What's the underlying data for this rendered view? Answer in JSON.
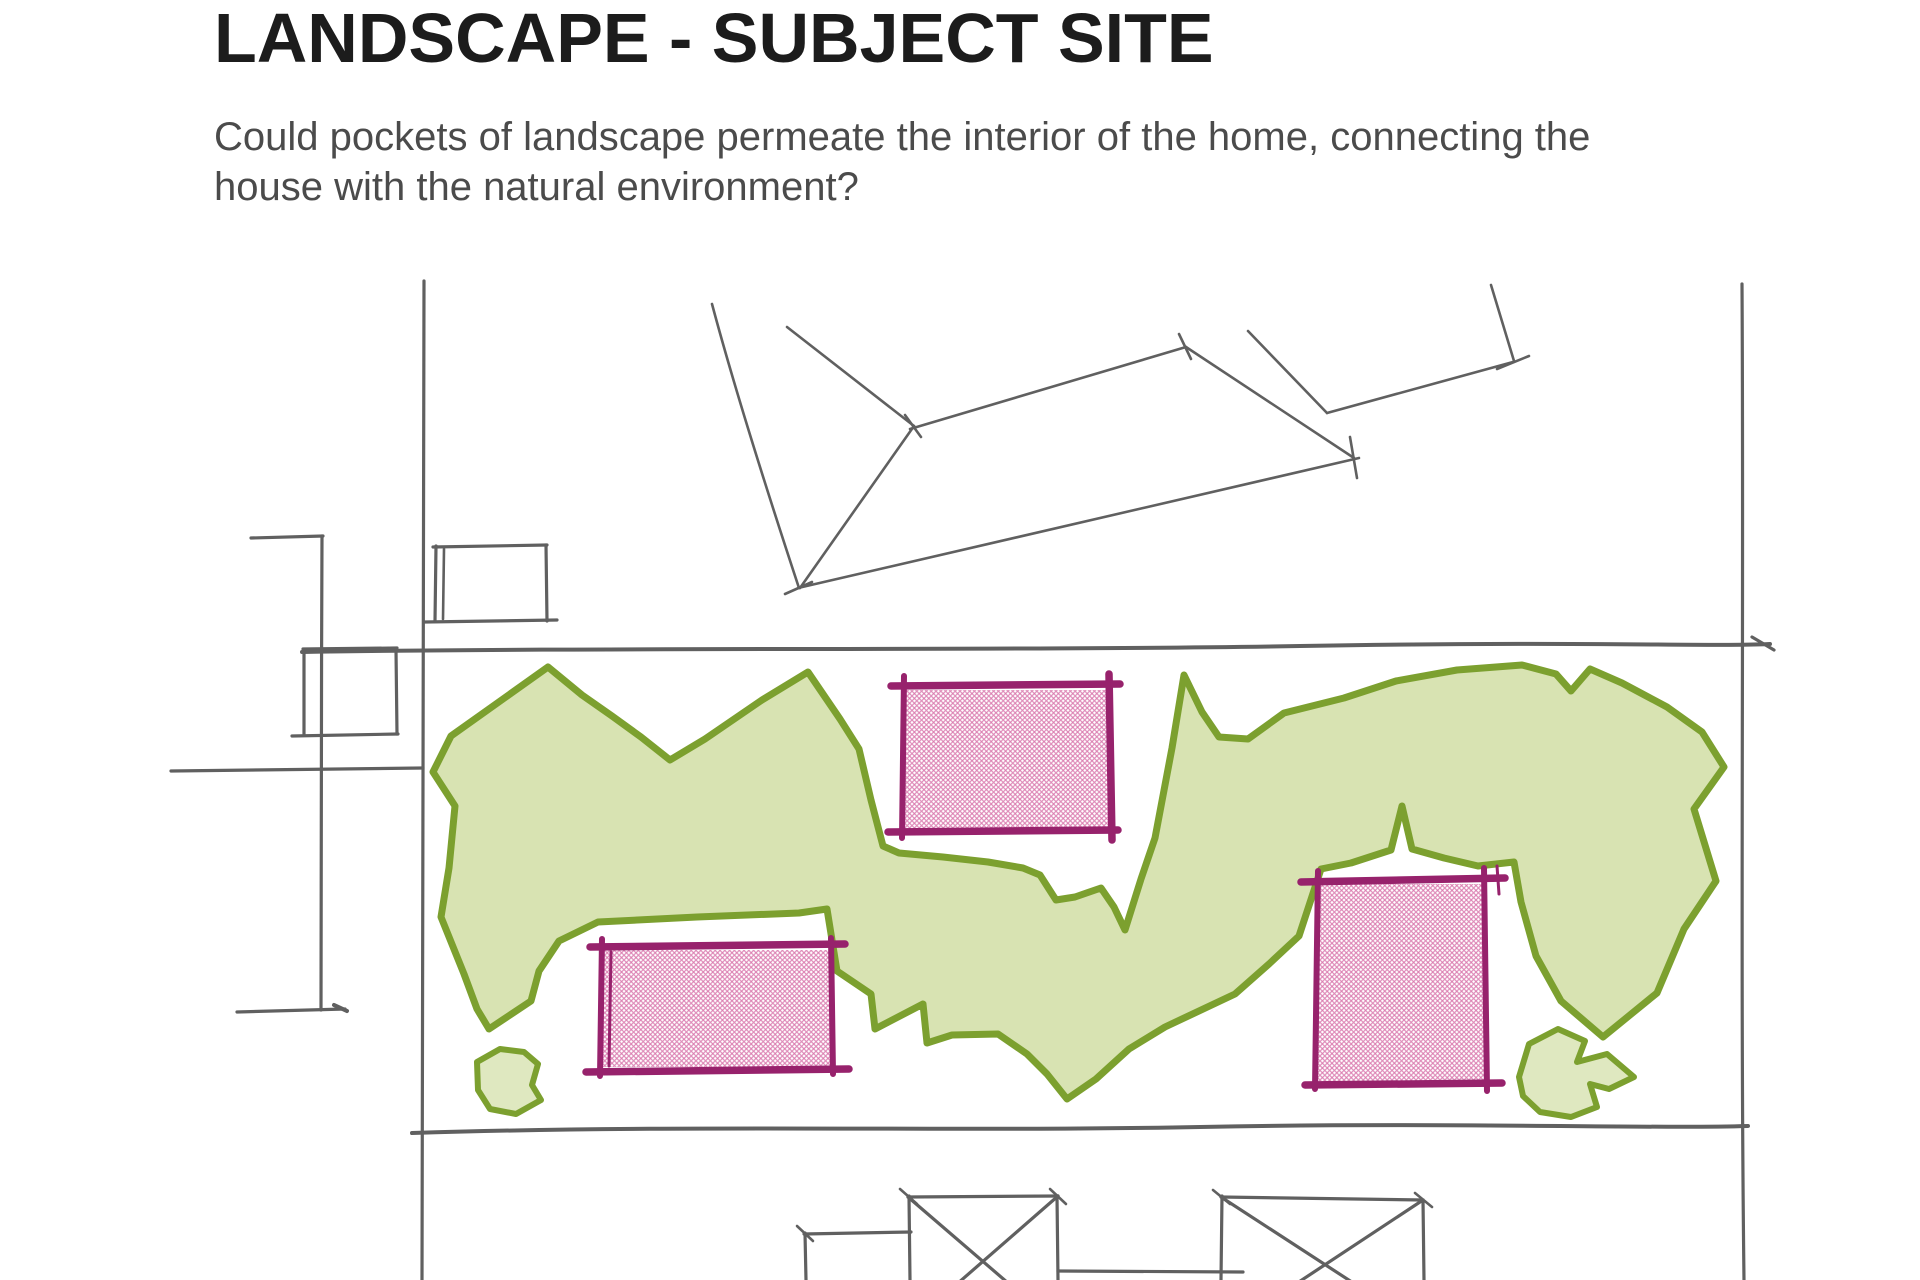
{
  "header": {
    "title": "LANDSCAPE - SUBJECT SITE",
    "subtitle_line1": "Could pockets of landscape permeate the interior of the home, connecting the",
    "subtitle_line2": "house with the natural environment?"
  },
  "sketch": {
    "description_labels": {
      "landscape_band": "landscape band",
      "courtyard_pockets": "hatched courtyard pockets",
      "site_boundary": "site boundary lines",
      "neighbour_roofs": "neighbouring roof outlines"
    }
  },
  "colors": {
    "page_bg": "#ffffff",
    "title_text": "#1c1c1c",
    "subtitle_text": "#4b4b4b",
    "sketch_line": "#606060",
    "landscape_outline": "#7ca02f",
    "landscape_fill": "#d8e3b2",
    "landscape_fill_light": "#dfe8c0",
    "courtyard_outline": "#97226c",
    "courtyard_hatch": "#d977ad"
  }
}
